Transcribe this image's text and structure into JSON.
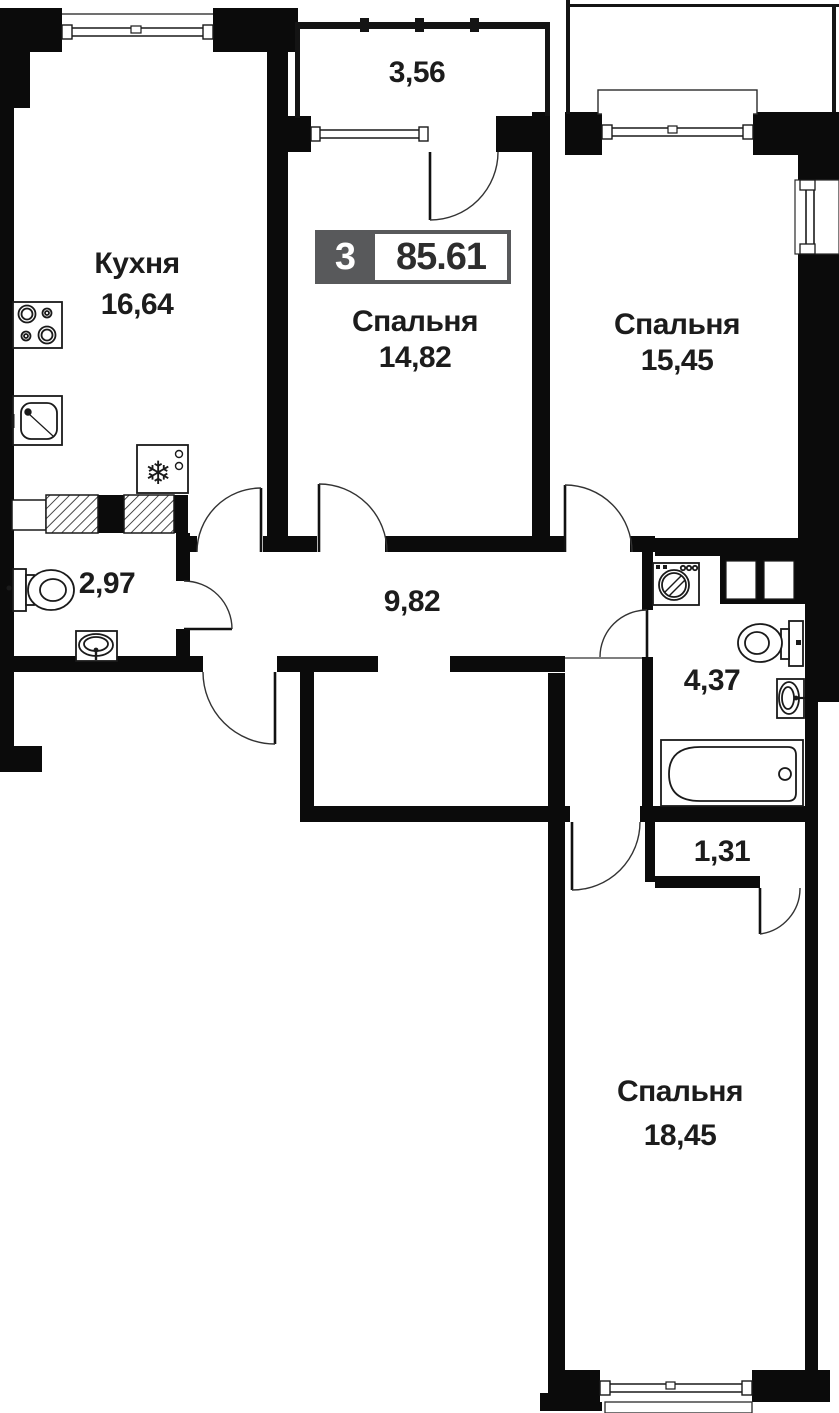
{
  "plan": {
    "badge": {
      "rooms_count": "3",
      "total_area": "85.61"
    },
    "rooms": {
      "balcony": {
        "area": "3,56"
      },
      "kitchen": {
        "name": "Кухня",
        "area": "16,64"
      },
      "bedroom1": {
        "name": "Спальня",
        "area": "14,82"
      },
      "bedroom2": {
        "name": "Спальня",
        "area": "15,45"
      },
      "wc": {
        "area": "2,97"
      },
      "hallway": {
        "area": "9,82"
      },
      "bathroom": {
        "area": "4,37"
      },
      "closet": {
        "area": "1,31"
      },
      "bedroom3": {
        "name": "Спальня",
        "area": "18,45"
      }
    },
    "icons": {
      "fridge_glyph": "❄"
    },
    "colors": {
      "wall": "#0b0b0b",
      "line": "#1a1a1a",
      "badge_gray": "#58595b",
      "text": "#1c1c1c",
      "bg": "#ffffff"
    }
  }
}
